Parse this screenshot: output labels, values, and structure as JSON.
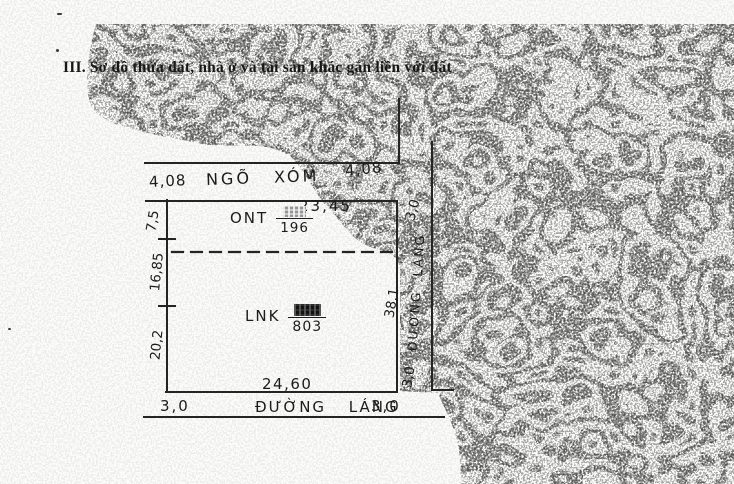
{
  "document": {
    "section_title": "III. Sơ đồ thửa đất, nhà ở và tài sản khác gắn liền với đất"
  },
  "diagram": {
    "alley": {
      "width_left": "4,08",
      "name": "NGÕ XÓM",
      "width_right": "4,08"
    },
    "parcel": {
      "top_length": "23,45",
      "bottom_length": "24,60",
      "right_length": "38,1",
      "left_lengths": {
        "upper": "7,5",
        "middle": "16,85",
        "lower": "20,2"
      },
      "zone_ont": {
        "code": "ONT",
        "area": "196",
        "numerator_redacted": "true"
      },
      "zone_lnk": {
        "code": "LNK",
        "area": "803",
        "numerator_redacted": "true"
      }
    },
    "road_right": {
      "width_top": "3,0",
      "name": "ĐƯỜNG LÁNG",
      "width_bottom": "3,0"
    },
    "road_bottom": {
      "width_left": "3,0",
      "name": "ĐƯỜNG LÁNG",
      "width_right": "3,0"
    }
  },
  "colors": {
    "ink": "#1c1c1c",
    "paper": "#fcfcfa",
    "noise": "#000000"
  }
}
